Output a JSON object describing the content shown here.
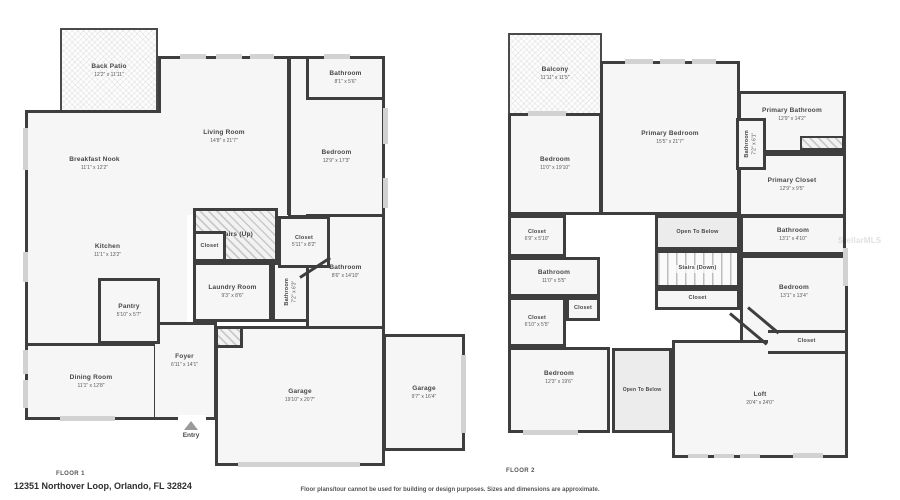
{
  "page": {
    "address": "12351 Northover Loop, Orlando, FL 32824",
    "disclaimer": "Floor plans/tour cannot be used for building or design purposes. Sizes and dimensions are approximate.",
    "watermark": "StellarMLS"
  },
  "floor1": {
    "label": "FLOOR 1",
    "entry_label": "Entry",
    "rooms": {
      "back_patio": {
        "name": "Back Patio",
        "dims": "12'2\" x 11'11\""
      },
      "living_room": {
        "name": "Living Room",
        "dims": "14'8\" x 21'7\""
      },
      "breakfast_nook": {
        "name": "Breakfast Nook",
        "dims": "11'1\" x 12'2\""
      },
      "bathroom_top": {
        "name": "Bathroom",
        "dims": "8'1\" x 5'6\""
      },
      "bedroom": {
        "name": "Bedroom",
        "dims": "12'9\" x 17'3\""
      },
      "kitchen": {
        "name": "Kitchen",
        "dims": "11'1\" x 13'2\""
      },
      "stairs_up": {
        "name": "Stairs (Up)"
      },
      "closet_stairs": {
        "name": "Closet"
      },
      "laundry": {
        "name": "Laundry Room",
        "dims": "9'3\" x 8'6\""
      },
      "bathroom_small": {
        "name": "Bathroom",
        "dims": "7'2\" x 6'3\""
      },
      "closet_hall": {
        "name": "Closet",
        "dims": "5'11\" x 8'2\""
      },
      "bathroom_big": {
        "name": "Bathroom",
        "dims": "8'6\" x 14'10\""
      },
      "pantry": {
        "name": "Pantry",
        "dims": "5'10\" x 5'7\""
      },
      "dining_room": {
        "name": "Dining Room",
        "dims": "11'1\" x 12'8\""
      },
      "foyer": {
        "name": "Foyer",
        "dims": "6'11\" x 14'1\""
      },
      "garage_main": {
        "name": "Garage",
        "dims": "19'10\" x 20'7\""
      },
      "garage_side": {
        "name": "Garage",
        "dims": "9'7\" x 16'4\""
      }
    }
  },
  "floor2": {
    "label": "FLOOR 2",
    "rooms": {
      "balcony": {
        "name": "Balcony",
        "dims": "11'11\" x 11'5\""
      },
      "primary_bedroom": {
        "name": "Primary Bedroom",
        "dims": "15'5\" x 21'7\""
      },
      "bedroom_topleft": {
        "name": "Bedroom",
        "dims": "11'0\" x 19'10\""
      },
      "primary_bathroom": {
        "name": "Primary Bathroom",
        "dims": "12'9\" x 14'2\""
      },
      "bathroom_small": {
        "name": "Bathroom",
        "dims": "7'2\" x 6'1\""
      },
      "primary_closet": {
        "name": "Primary Closet",
        "dims": "12'9\" x 9'5\""
      },
      "closet_a": {
        "name": "Closet",
        "dims": "6'9\" x 5'10\""
      },
      "bathroom_left": {
        "name": "Bathroom",
        "dims": "11'0\" x 5'5\""
      },
      "closet_mid": {
        "name": "Closet"
      },
      "closet_b": {
        "name": "Closet",
        "dims": "6'10\" x 5'5\""
      },
      "bedroom_left": {
        "name": "Bedroom",
        "dims": "12'3\" x 19'6\""
      },
      "open_below_upper": {
        "name": "Open To Below"
      },
      "bathroom_right": {
        "name": "Bathroom",
        "dims": "13'1\" x 4'10\""
      },
      "stairs_down": {
        "name": "Stairs (Down)"
      },
      "closet_stairs": {
        "name": "Closet"
      },
      "bedroom_right": {
        "name": "Bedroom",
        "dims": "13'1\" x 13'4\""
      },
      "closet_right": {
        "name": "Closet"
      },
      "open_below_lower": {
        "name": "Open To Below"
      },
      "loft": {
        "name": "Loft",
        "dims": "20'4\" x 24'0\""
      }
    }
  }
}
